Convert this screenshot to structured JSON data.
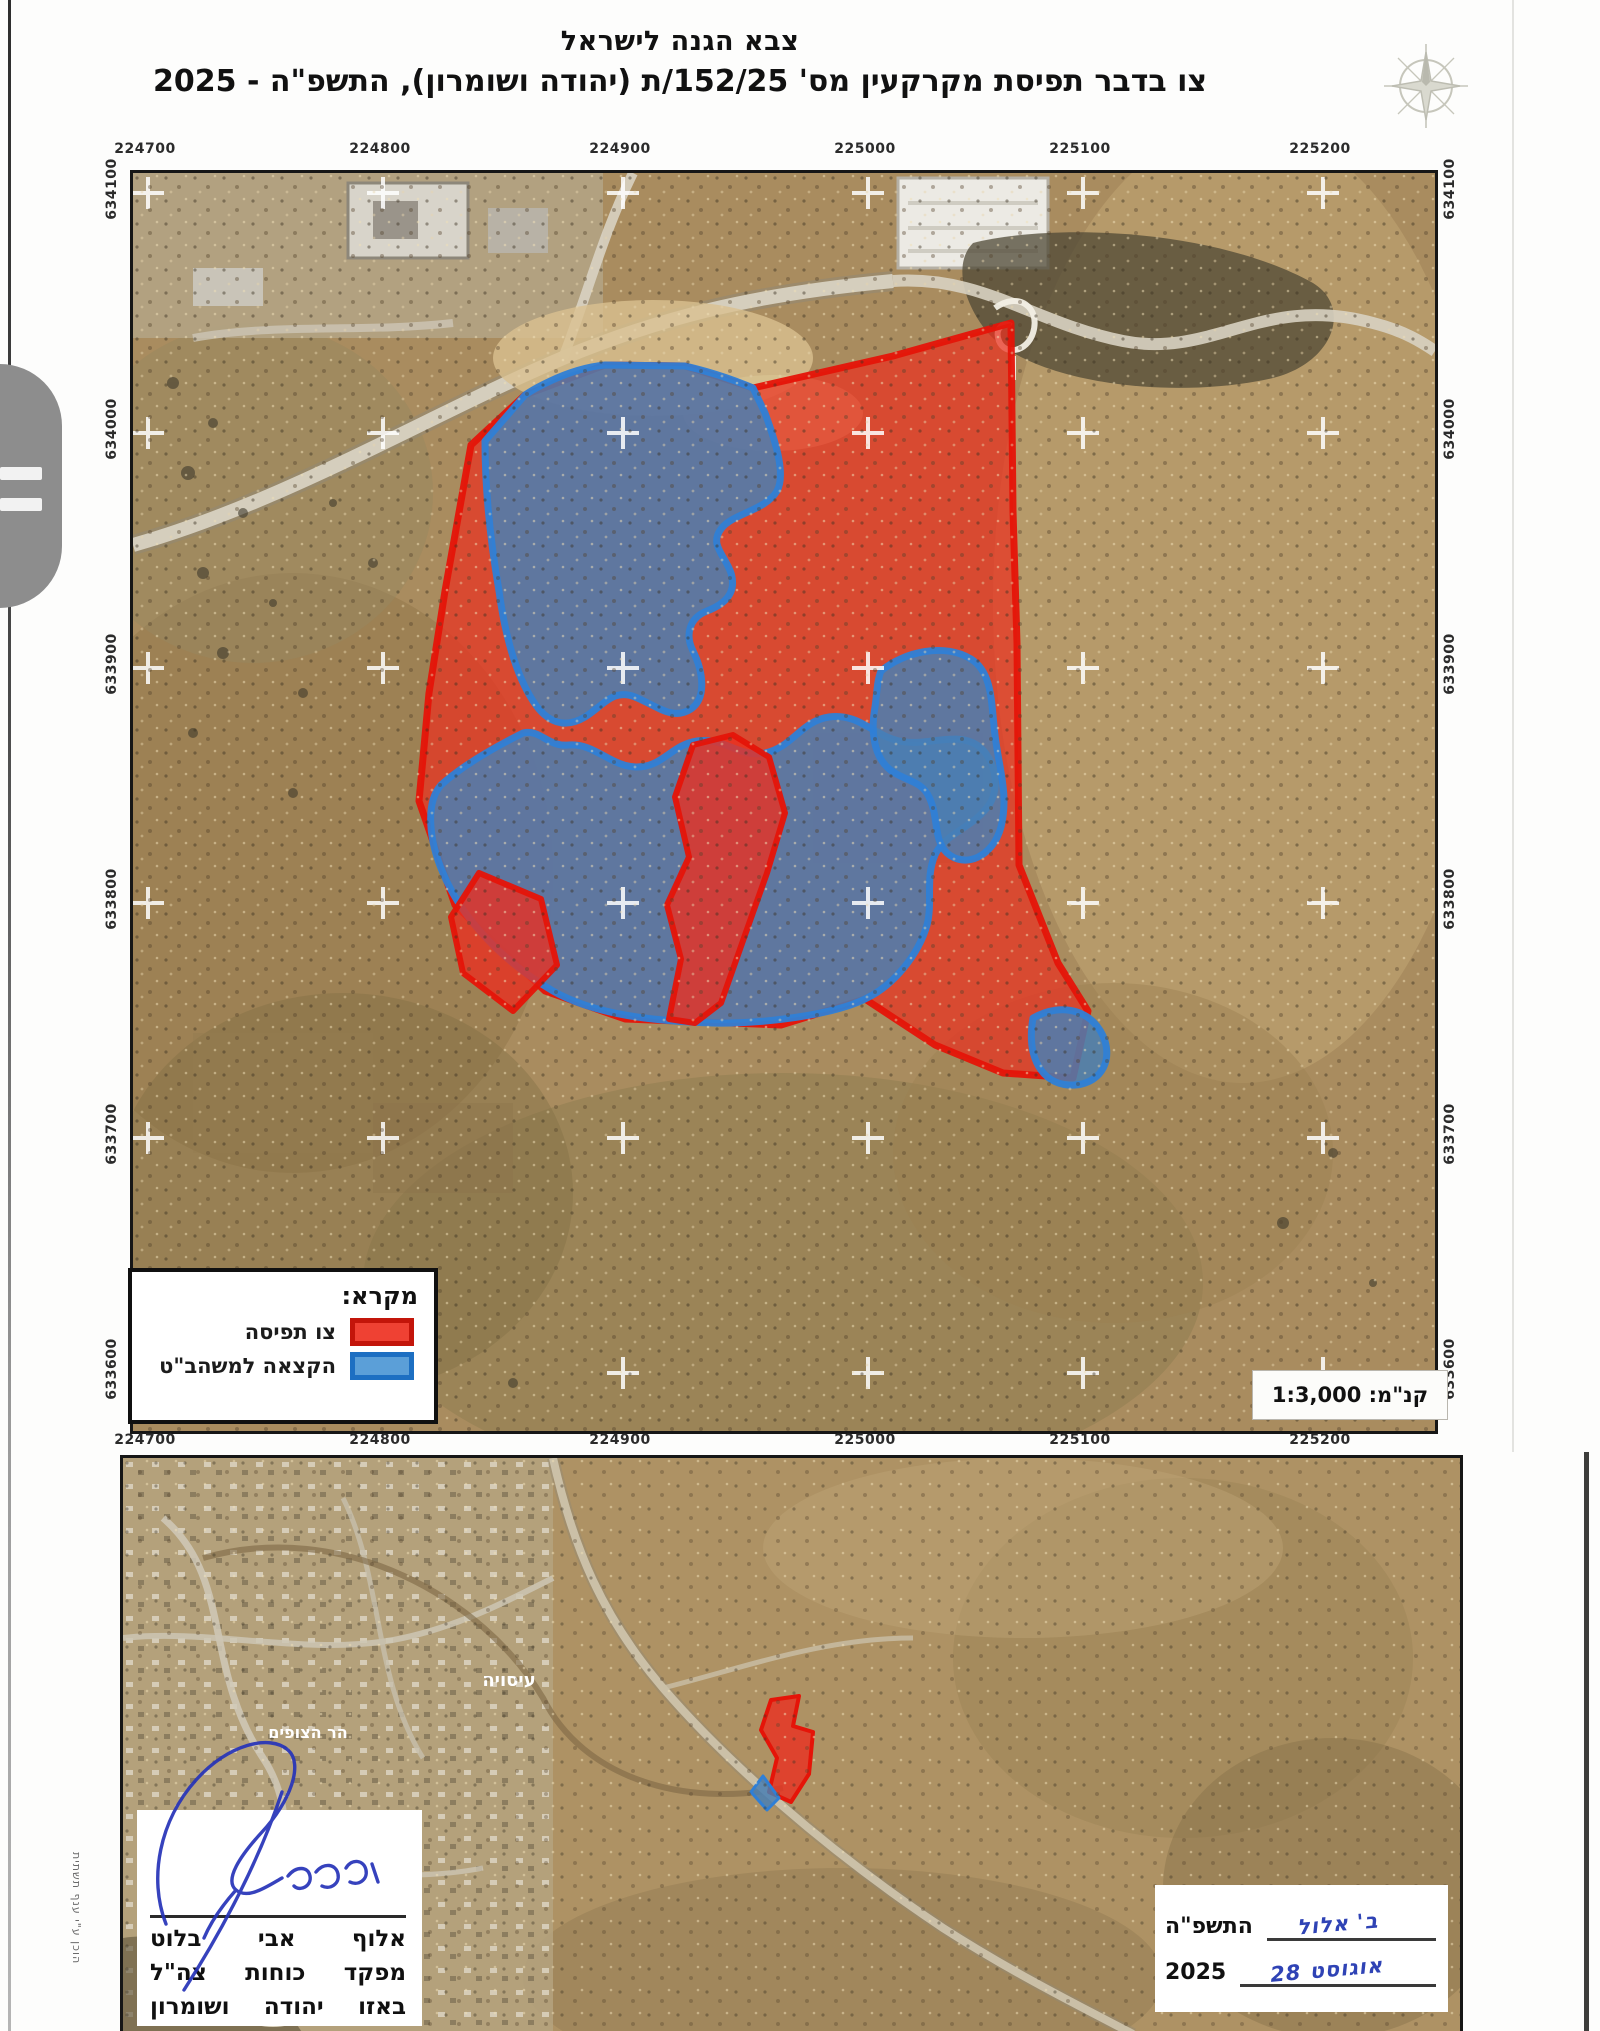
{
  "header": {
    "title_line1": "צבא הגנה לישראל",
    "title_line2": "צו בדבר תפיסת מקרקעין מס' 152/25/ת (יהודה ושומרון), התשפ\"ה - 2025"
  },
  "main_map": {
    "x_coords": [
      "224700",
      "224800",
      "224900",
      "225000",
      "225100",
      "225200"
    ],
    "y_coords": [
      "634100",
      "634000",
      "633900",
      "633800",
      "633700",
      "633600"
    ],
    "scale_label": "קנ\"מ: 1:3,000",
    "legend": {
      "title": "מקרא:",
      "items": [
        {
          "label": "צו תפיסה",
          "color": "#e6281c"
        },
        {
          "label": "הקצאה למשהב\"ט",
          "color": "#3d7ec9"
        }
      ]
    }
  },
  "overview_map": {
    "place_labels": [
      "עיסויה",
      "הר הצופים"
    ]
  },
  "signature_block": {
    "line1": "אלוף אבי בלוט",
    "line2": "מפקד כוחות צה\"ל",
    "line3": "באזו יהודה ושומרון"
  },
  "date_block": {
    "hebrew_year": "התשפ\"ה",
    "gregorian_year": "2025",
    "hebrew_date_handwritten": "ב' אלול",
    "gregorian_date_handwritten": "אוגוסט 28"
  },
  "side_note": "הוכן ע\"י ענף תשתית",
  "colors": {
    "seizure_red": "#e6281c",
    "allocation_blue": "#3d7ec9",
    "terrain_tan": "#a98c5f"
  }
}
